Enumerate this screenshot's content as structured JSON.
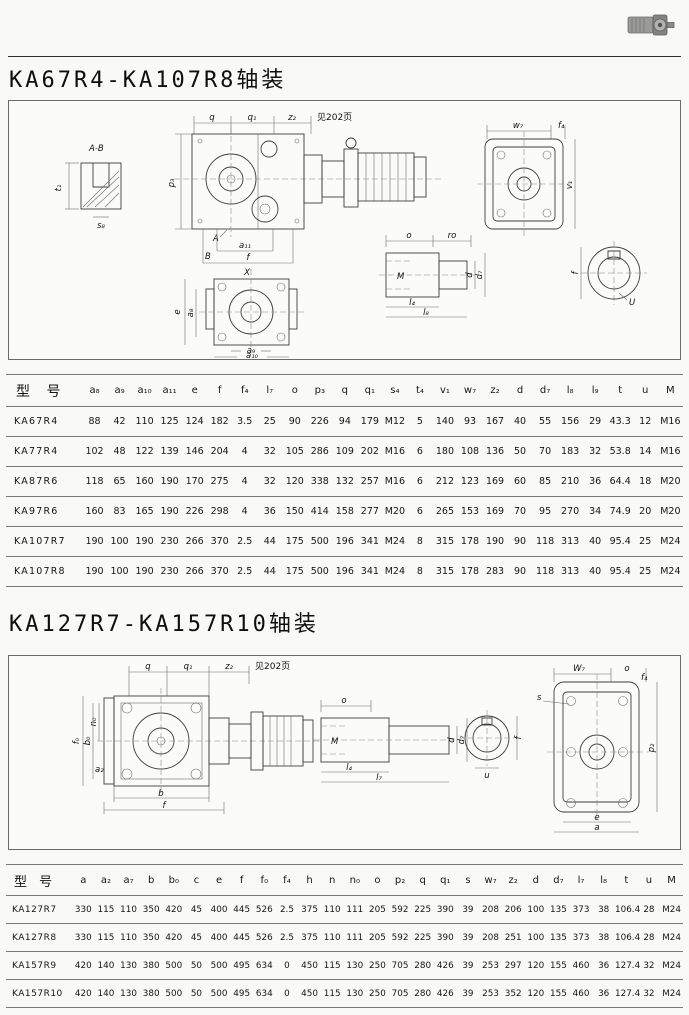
{
  "page": {
    "section1_title": "KA67R4-KA107R8轴装",
    "section2_title": "KA127R7-KA157R10轴装"
  },
  "fig1": {
    "note": "见202页",
    "labels": {
      "ab": "A-B",
      "t1": "t₁",
      "s8": "s₈",
      "q": "q",
      "q1": "q₁",
      "z2": "z₂",
      "p3": "p₃",
      "A": "A",
      "B": "B",
      "a11": "a₁₁",
      "f": "f",
      "X": "X",
      "e": "e",
      "a8": "a₈",
      "a9": "a₉",
      "a10": "a₁₀",
      "o": "o",
      "ro": "ro",
      "M": "M",
      "d": "d",
      "d7": "d₇",
      "l4": "l₄",
      "l8": "l₈",
      "w7": "w₇",
      "f4": "f₄",
      "v1": "v₁",
      "fcirc": "f",
      "U": "U"
    }
  },
  "fig2": {
    "note": "见202页",
    "labels": {
      "q": "q",
      "q1": "q₁",
      "z2": "z₂",
      "n0": "n₀",
      "f0": "f₀",
      "b0": "b₀",
      "a2": "a₂",
      "b": "b",
      "f": "f",
      "o": "o",
      "M": "M",
      "d": "d",
      "d7": "d₇",
      "l4": "l₄",
      "l7": "l₇",
      "fcirc": "f",
      "u": "u",
      "W7": "W₇",
      "o2": "o",
      "s": "s",
      "f4": "f₄",
      "p2": "p₂",
      "e": "e",
      "a": "a"
    }
  },
  "table1": {
    "headers": [
      "型 号",
      "a₈",
      "a₉",
      "a₁₀",
      "a₁₁",
      "e",
      "f",
      "f₄",
      "l₇",
      "o",
      "p₃",
      "q",
      "q₁",
      "s₄",
      "t₄",
      "v₁",
      "w₇",
      "z₂",
      "d",
      "d₇",
      "l₈",
      "l₉",
      "t",
      "u",
      "M"
    ],
    "rows": [
      [
        "KA67R4",
        "88",
        "42",
        "110",
        "125",
        "124",
        "182",
        "3.5",
        "25",
        "90",
        "226",
        "94",
        "179",
        "M12",
        "5",
        "140",
        "93",
        "167",
        "40",
        "55",
        "156",
        "29",
        "43.3",
        "12",
        "M16"
      ],
      [
        "KA77R4",
        "102",
        "48",
        "122",
        "139",
        "146",
        "204",
        "4",
        "32",
        "105",
        "286",
        "109",
        "202",
        "M16",
        "6",
        "180",
        "108",
        "136",
        "50",
        "70",
        "183",
        "32",
        "53.8",
        "14",
        "M16"
      ],
      [
        "KA87R6",
        "118",
        "65",
        "160",
        "190",
        "170",
        "275",
        "4",
        "32",
        "120",
        "338",
        "132",
        "257",
        "M16",
        "6",
        "212",
        "123",
        "169",
        "60",
        "85",
        "210",
        "36",
        "64.4",
        "18",
        "M20"
      ],
      [
        "KA97R6",
        "160",
        "83",
        "165",
        "190",
        "226",
        "298",
        "4",
        "36",
        "150",
        "414",
        "158",
        "277",
        "M20",
        "6",
        "265",
        "153",
        "169",
        "70",
        "95",
        "270",
        "34",
        "74.9",
        "20",
        "M20"
      ],
      [
        "KA107R7",
        "190",
        "100",
        "190",
        "230",
        "266",
        "370",
        "2.5",
        "44",
        "175",
        "500",
        "196",
        "341",
        "M24",
        "8",
        "315",
        "178",
        "190",
        "90",
        "118",
        "313",
        "40",
        "95.4",
        "25",
        "M24"
      ],
      [
        "KA107R8",
        "190",
        "100",
        "190",
        "230",
        "266",
        "370",
        "2.5",
        "44",
        "175",
        "500",
        "196",
        "341",
        "M24",
        "8",
        "315",
        "178",
        "283",
        "90",
        "118",
        "313",
        "40",
        "95.4",
        "25",
        "M24"
      ]
    ]
  },
  "table2": {
    "headers": [
      "型 号",
      "a",
      "a₂",
      "a₇",
      "b",
      "b₀",
      "c",
      "e",
      "f",
      "f₀",
      "f₄",
      "h",
      "n",
      "n₀",
      "o",
      "p₂",
      "q",
      "q₁",
      "s",
      "w₇",
      "z₂",
      "d",
      "d₇",
      "l₇",
      "l₈",
      "t",
      "u",
      "M"
    ],
    "rows": [
      [
        "KA127R7",
        "330",
        "115",
        "110",
        "350",
        "420",
        "45",
        "400",
        "445",
        "526",
        "2.5",
        "375",
        "110",
        "111",
        "205",
        "592",
        "225",
        "390",
        "39",
        "208",
        "206",
        "100",
        "135",
        "373",
        "38",
        "106.4",
        "28",
        "M24"
      ],
      [
        "KA127R8",
        "330",
        "115",
        "110",
        "350",
        "420",
        "45",
        "400",
        "445",
        "526",
        "2.5",
        "375",
        "110",
        "111",
        "205",
        "592",
        "225",
        "390",
        "39",
        "208",
        "251",
        "100",
        "135",
        "373",
        "38",
        "106.4",
        "28",
        "M24"
      ],
      [
        "KA157R9",
        "420",
        "140",
        "130",
        "380",
        "500",
        "50",
        "500",
        "495",
        "634",
        "0",
        "450",
        "115",
        "130",
        "250",
        "705",
        "280",
        "426",
        "39",
        "253",
        "297",
        "120",
        "155",
        "460",
        "36",
        "127.4",
        "32",
        "M24"
      ],
      [
        "KA157R10",
        "420",
        "140",
        "130",
        "380",
        "500",
        "50",
        "500",
        "495",
        "634",
        "0",
        "450",
        "115",
        "130",
        "250",
        "705",
        "280",
        "426",
        "39",
        "253",
        "352",
        "120",
        "155",
        "460",
        "36",
        "127.4",
        "32",
        "M24"
      ]
    ]
  }
}
